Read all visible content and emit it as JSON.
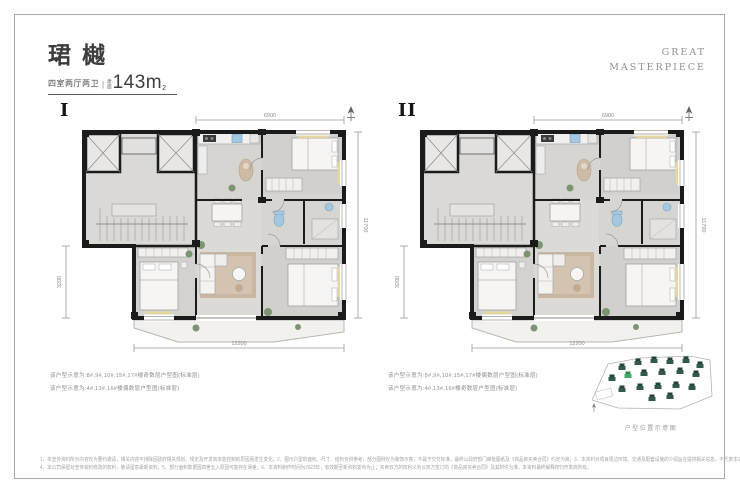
{
  "header": {
    "title": "珺樾",
    "subtitle": "四室两厅两卫",
    "divider": "|",
    "area_label_1": "建",
    "area_label_2": "面",
    "area_value": "143m",
    "area_sup": "2",
    "brand": {
      "line1": "GREAT",
      "line2": "MASTERPIECE"
    }
  },
  "plans": [
    {
      "label": "I",
      "captions": [
        "该户型示意为:8#,9#,10#,15#,17#楼奇数层户型图(标准层)",
        "该户型示意为:4#,13#,16#楼偶数层户型图(标准层)"
      ],
      "dims": {
        "top": "6900",
        "right": "11700",
        "left": "3200",
        "bottom": "12200"
      }
    },
    {
      "label": "II",
      "captions": [
        "该户型示意为:8#,9#,10#,15#,17#楼偶数层户型图(标准层)",
        "该户型示意为:4#,13#,16#楼奇数层户型图(标准层)"
      ],
      "dims": {
        "top": "6900",
        "right": "11700",
        "left": "3200",
        "bottom": "12200"
      }
    }
  ],
  "siteplan": {
    "caption": "户型位置示意图"
  },
  "disclaimer": {
    "line1": "1、本宣传资料所示内容仅为要约邀请，相关内容不排除因政府相关规划、规定及开发商未能控制的原因而发生变化；2、图示户型的面积、尺寸、结构仅供参考，部分图例仅为装饰示意，不属于交付标准，最终以政府部门审批图纸及《商品房买卖合同》约定为准；3、本资料对项目周边环境、交通及配套设施的介绍旨在提供相关信息，不代表本公司对此作出承诺；",
    "line2": "4、本公司保留对宣传资料修改的权利，敬请留意最新资料；5、部分面积数据因四舍五入原因可能存在误差；6、本资料制作时间为2023年，有效期至新资料发布为止；买卖双方的权利义务以双方签订的《商品房买卖合同》及其附件为准，本资料最终解释权归开发商所有。"
  },
  "colors": {
    "wall": "#1b1b1b",
    "wood_accent": "#c9b7a2",
    "fixture_blue": "#a5c8e1",
    "window_yellow": "#e6d79e",
    "plant_green": "#7c9471",
    "site_building": "#33584d",
    "site_highlight": "#3fae6e"
  }
}
